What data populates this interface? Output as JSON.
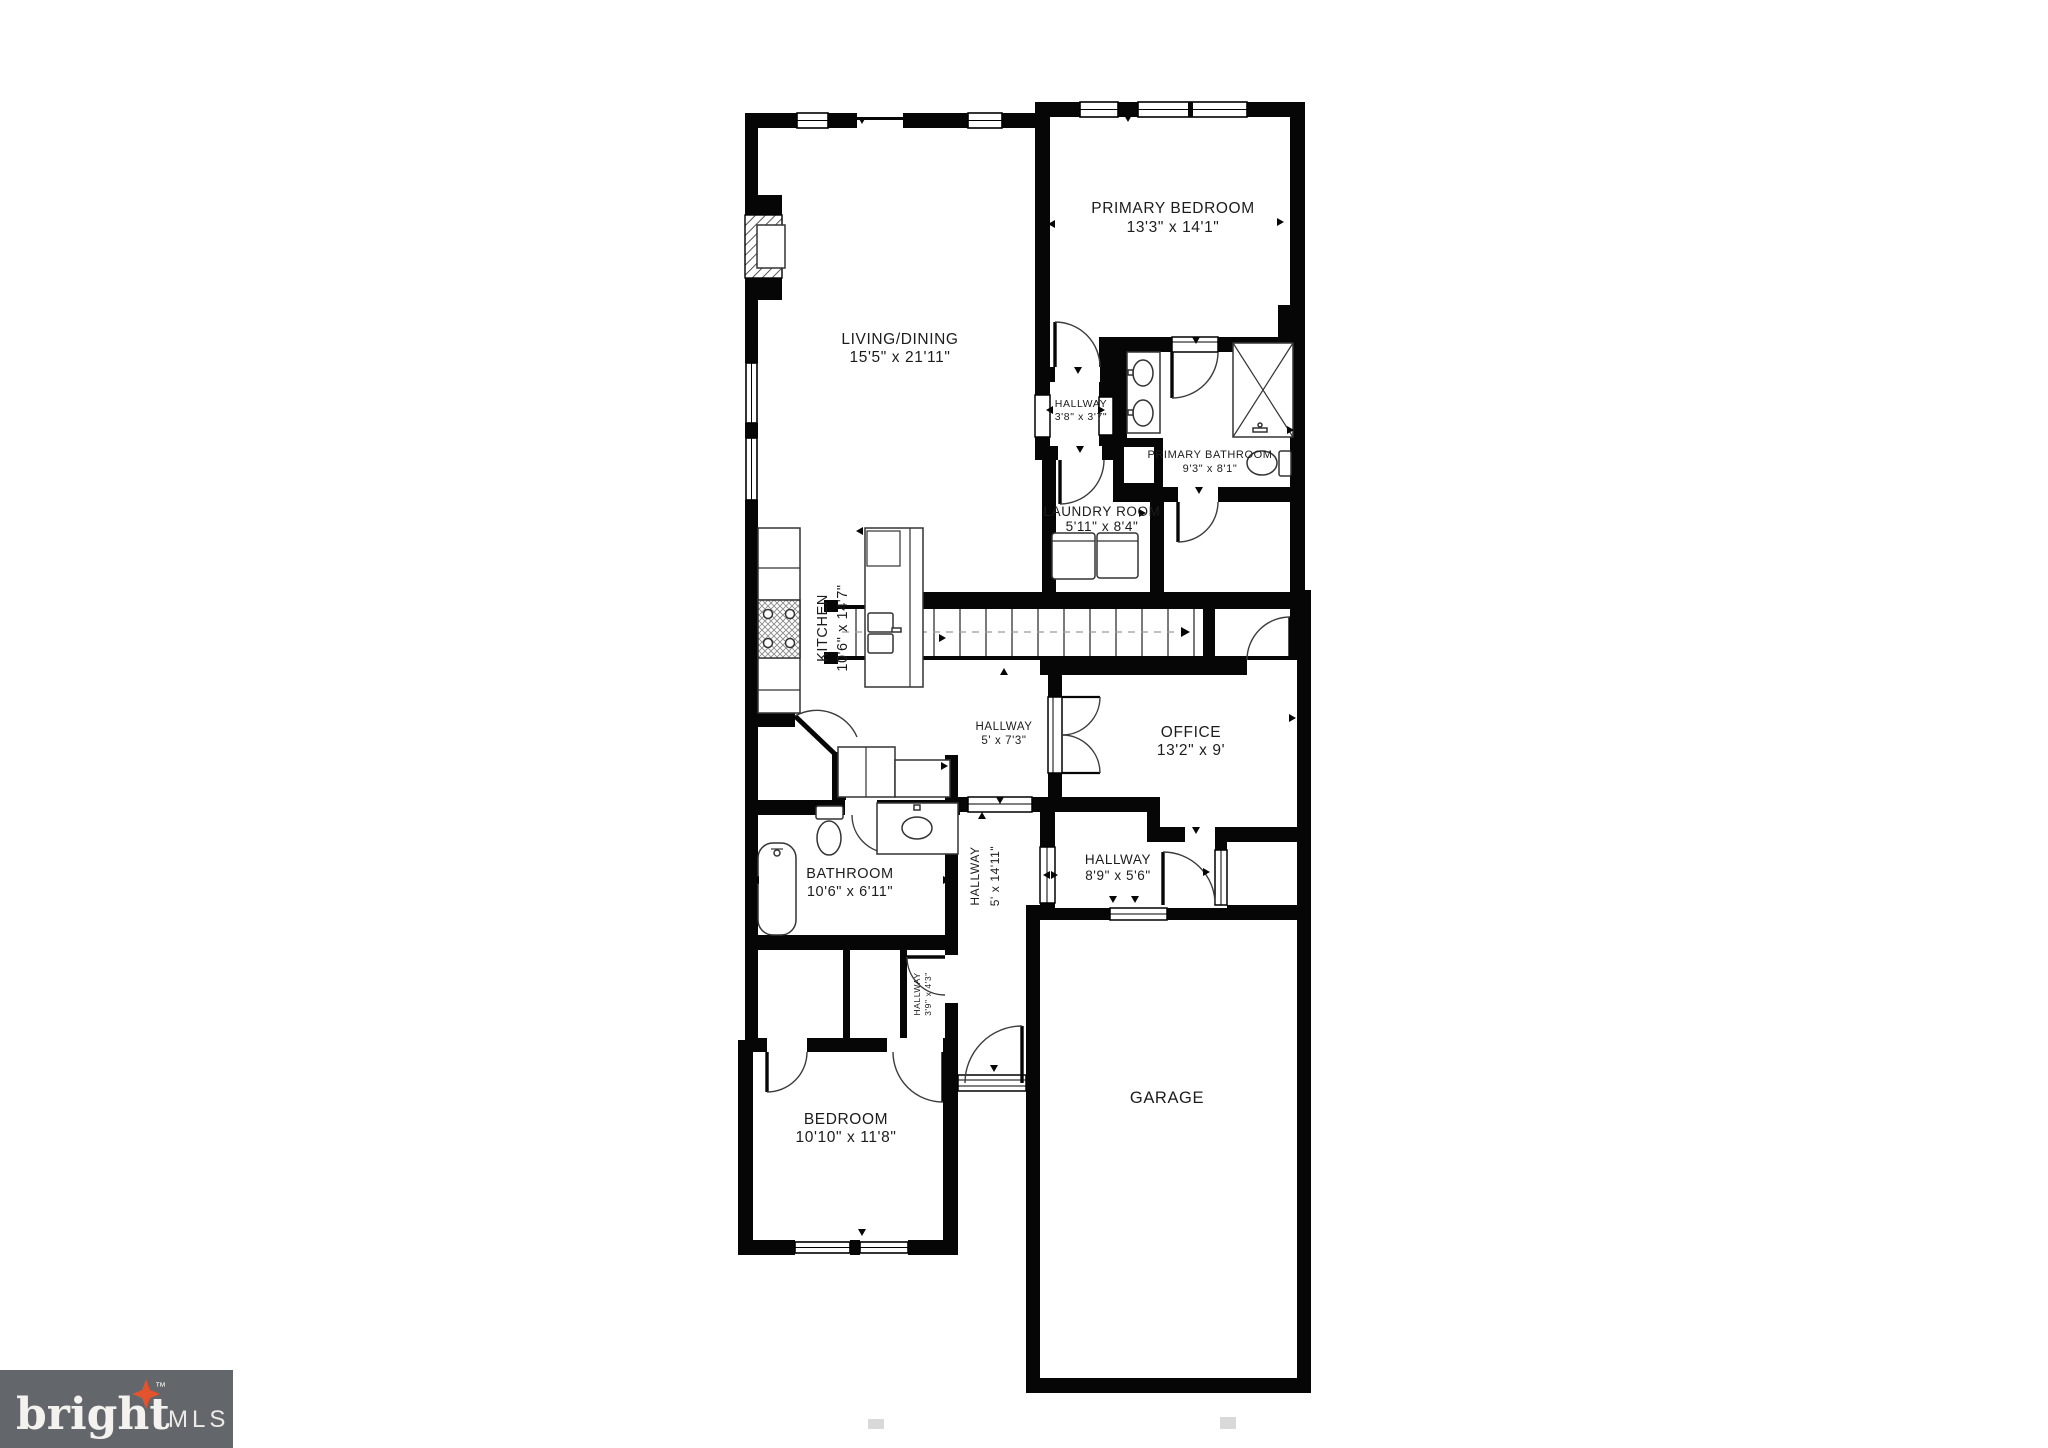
{
  "floorplan": {
    "rooms": [
      {
        "id": "primary-bedroom",
        "name": "PRIMARY BEDROOM",
        "dims": "13'3\" x 14'1\""
      },
      {
        "id": "living-dining",
        "name": "LIVING/DINING",
        "dims": "15'5\" x 21'11\""
      },
      {
        "id": "hallway-upper",
        "name": "HALLWAY",
        "dims": "3'8\" x 3'7\""
      },
      {
        "id": "primary-bathroom",
        "name": "PRIMARY BATHROOM",
        "dims": "9'3\" x 8'1\""
      },
      {
        "id": "laundry-room",
        "name": "LAUNDRY ROOM",
        "dims": "5'11\" x 8'4\""
      },
      {
        "id": "kitchen",
        "name": "KITCHEN",
        "dims": "10'6\" x 14'7\""
      },
      {
        "id": "hallway-center",
        "name": "HALLWAY",
        "dims": "5' x 7'3\""
      },
      {
        "id": "office",
        "name": "OFFICE",
        "dims": "13'2\" x 9'"
      },
      {
        "id": "hallway-garage",
        "name": "HALLWAY",
        "dims": "8'9\" x 5'6\""
      },
      {
        "id": "bathroom",
        "name": "BATHROOM",
        "dims": "10'6\" x 6'11\""
      },
      {
        "id": "hallway-main",
        "name": "HALLWAY",
        "dims": "5' x 14'11\""
      },
      {
        "id": "hallway-small",
        "name": "HALLWAY",
        "dims": "3'9\" x 4'3\""
      },
      {
        "id": "bedroom",
        "name": "BEDROOM",
        "dims": "10'10\" x 11'8\""
      },
      {
        "id": "garage",
        "name": "GARAGE",
        "dims": ""
      }
    ],
    "watermark": {
      "brand": "bright",
      "tm": "™",
      "suffix": "MLS"
    },
    "colors": {
      "wall": "#060606",
      "label": "#1c1c1c",
      "logo_bg": "#63666a",
      "logo_text": "#f4f2ee",
      "logo_star": "#e2532e"
    }
  }
}
